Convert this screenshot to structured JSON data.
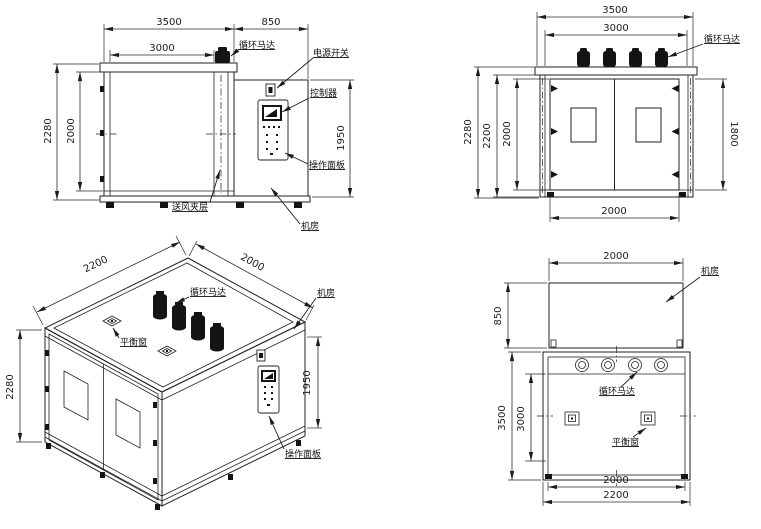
{
  "drawing_title": "环境试验箱四视图 (chamber four-view drawing)",
  "colors": {
    "line": "#222222",
    "background": "#ffffff",
    "solid_fill": "#141414"
  },
  "views": {
    "side": {
      "dims": {
        "total_width": "3500",
        "room_width": "850",
        "inner_width": "3000",
        "outer_height": "2280",
        "inner_height": "2000",
        "room_height": "1950"
      },
      "labels": {
        "motor": "循环马达",
        "power_switch": "电源开关",
        "controller": "控制器",
        "control_panel": "操作面板",
        "air_plenum": "送风夹层",
        "machine_room": "机房"
      }
    },
    "front": {
      "dims": {
        "total_width": "3500",
        "inner_width": "3000",
        "outer_height": "2280",
        "mid_height": "2200",
        "inner_height": "2000",
        "door_height": "1800",
        "door_width": "2000"
      },
      "labels": {
        "motor": "循环马达"
      }
    },
    "iso": {
      "dims": {
        "depth": "2200",
        "width": "2000",
        "outer_height": "2280",
        "room_height": "1950"
      },
      "labels": {
        "motor": "循环马达",
        "balance_window": "平衡窗",
        "machine_room": "机房",
        "control_panel": "操作面板"
      }
    },
    "plan": {
      "dims": {
        "room_width": "2000",
        "room_depth": "850",
        "total_depth": "3500",
        "inner_depth": "3000",
        "inner_width": "2000",
        "total_width": "2200"
      },
      "labels": {
        "machine_room": "机房",
        "motor": "循环马达",
        "balance_window": "平衡窗"
      }
    }
  }
}
